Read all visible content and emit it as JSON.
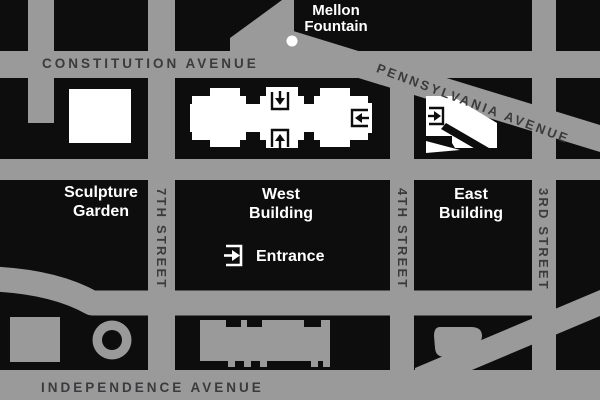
{
  "map": {
    "description": "Street map of National Gallery area bounded by Constitution Avenue, Pennsylvania Avenue and Independence Avenue",
    "streets": {
      "constitution": "CONSTITUTION AVENUE",
      "pennsylvania": "PENNSYLVANIA AVENUE",
      "independence": "INDEPENDENCE AVENUE",
      "seventh": "7TH STREET",
      "fourth": "4TH STREET",
      "third": "3RD STREET"
    },
    "places": {
      "mellon_line1": "Mellon",
      "mellon_line2": "Fountain",
      "sculpture_line1": "Sculpture",
      "sculpture_line2": "Garden",
      "west_line1": "West",
      "west_line2": "Building",
      "east_line1": "East",
      "east_line2": "Building",
      "entrance": "Entrance"
    },
    "icons": {
      "entrance_arrow": "arrow-into-bracket entrance marker",
      "mellon_dot": "white circular fountain marker"
    },
    "colors": {
      "background": "#0d0d0e",
      "road": "#9a9a9a",
      "road_text": "#3b3b3d",
      "building_white": "#ffffff"
    }
  }
}
